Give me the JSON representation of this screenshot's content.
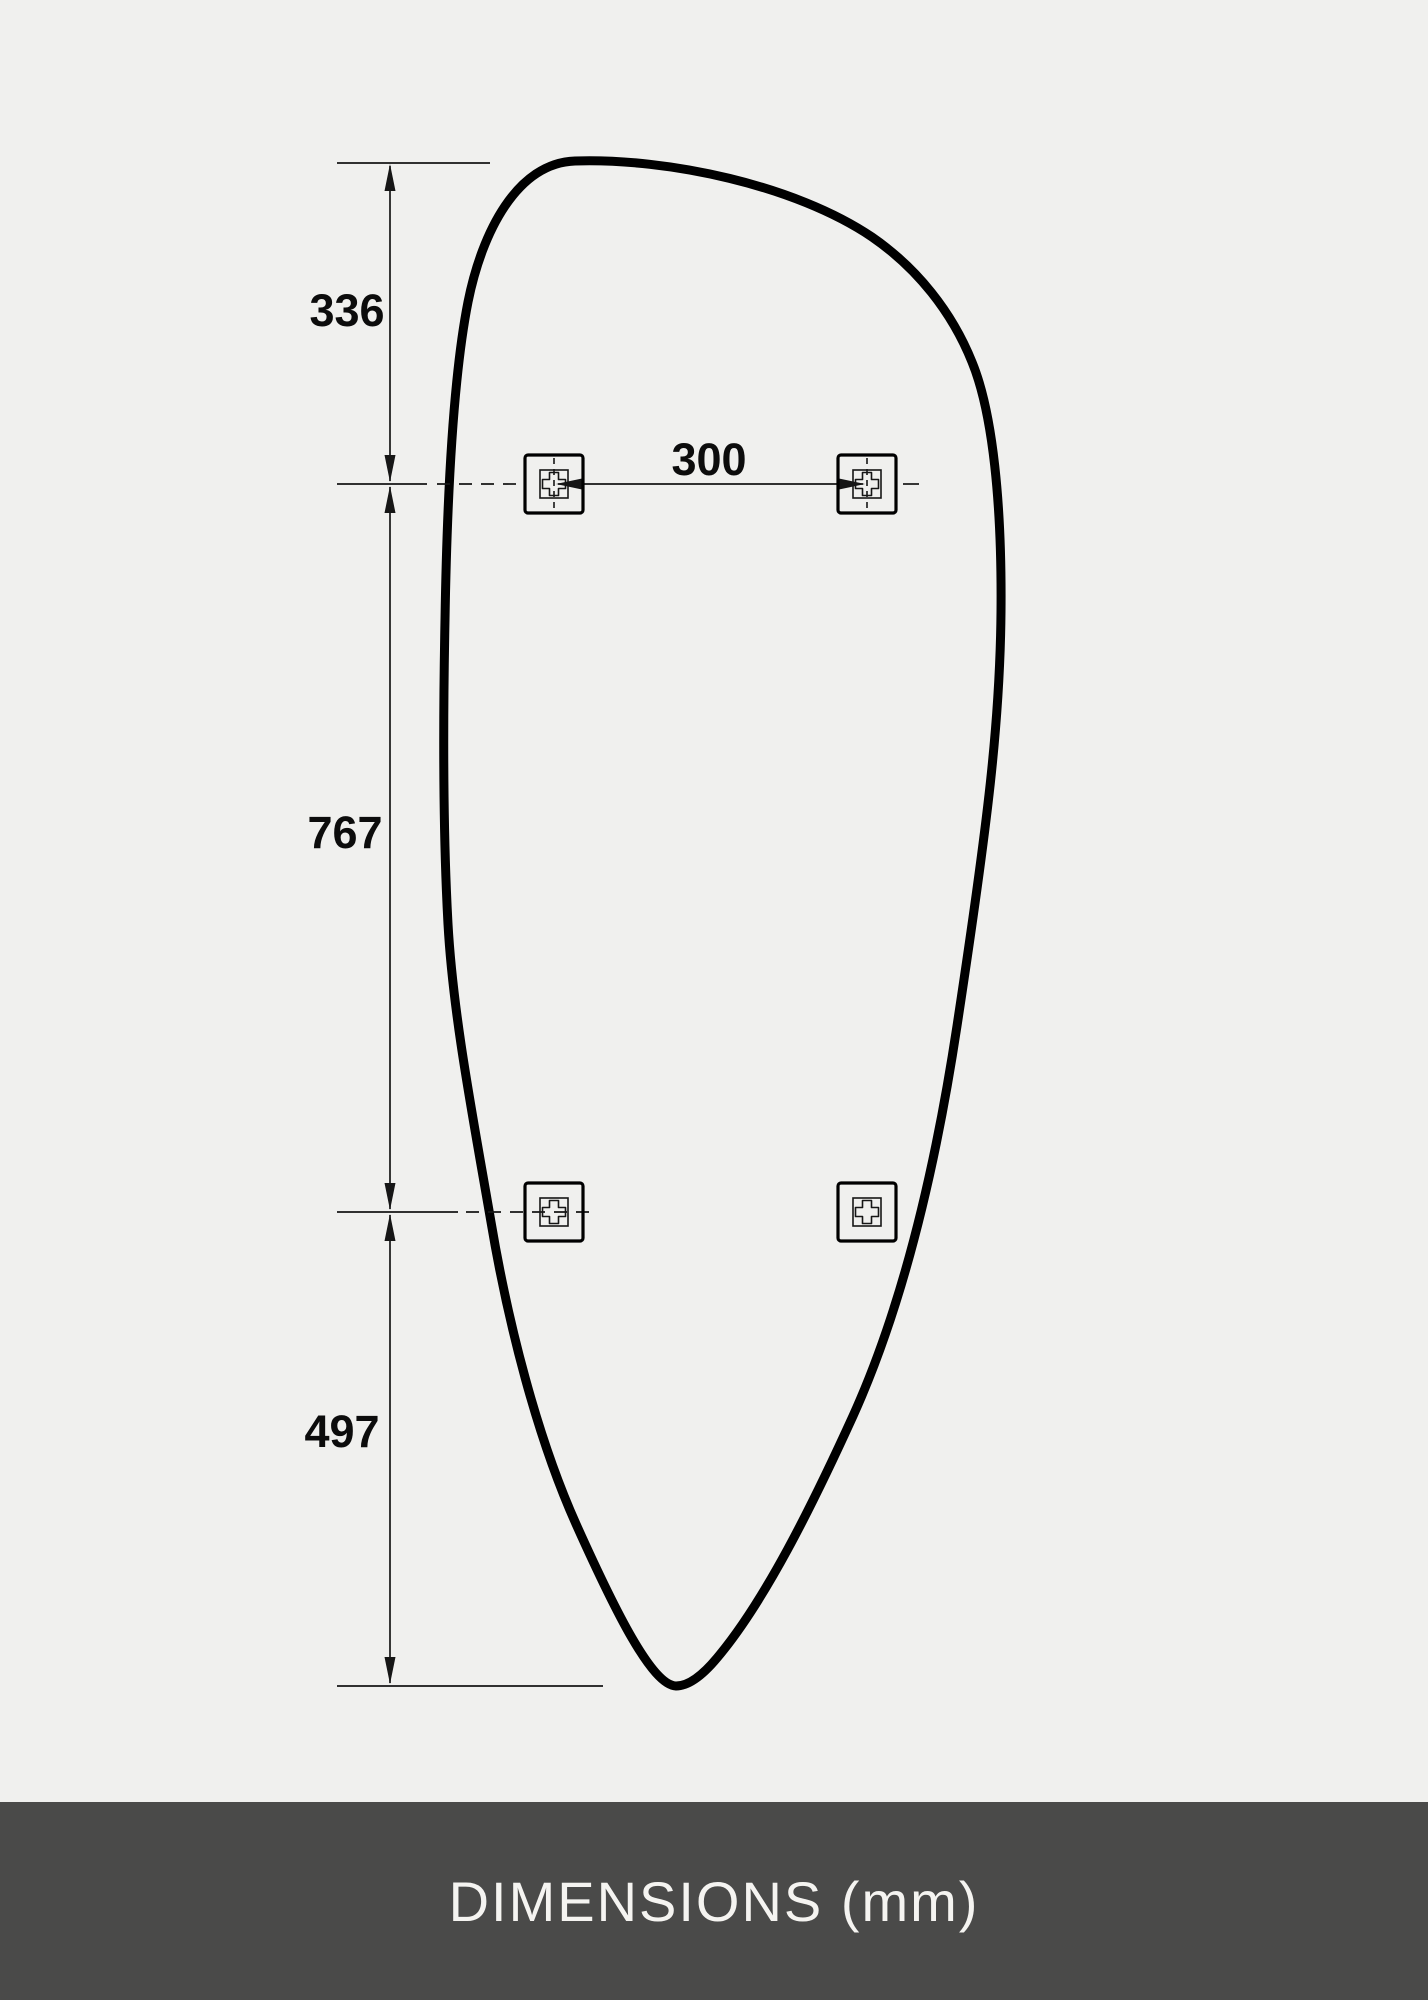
{
  "footer": {
    "label": "DIMENSIONS (mm)"
  },
  "dimensions": {
    "top_segment_mm": "336",
    "middle_segment_mm": "767",
    "bottom_segment_mm": "497",
    "bracket_spacing_mm": "300"
  },
  "colors": {
    "background": "#f0f0ee",
    "line": "#161616",
    "outline": "#000000",
    "footer_bg": "#4a4a49",
    "footer_text": "#f5f4f1"
  }
}
